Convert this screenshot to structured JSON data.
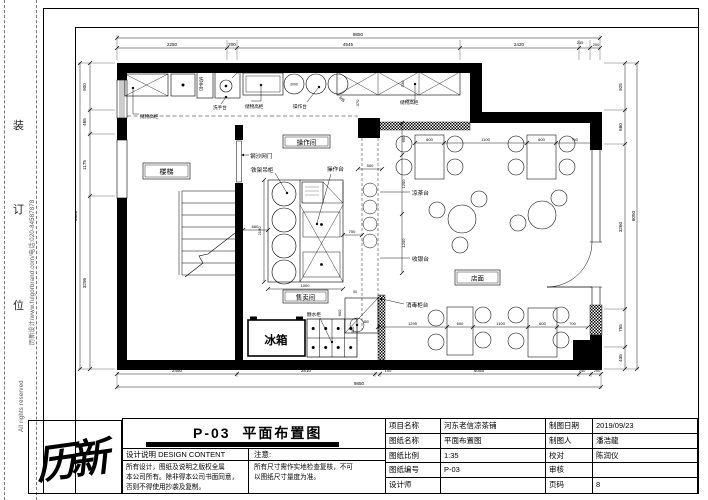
{
  "sheet": {
    "binding": [
      "装",
      "订",
      "位"
    ],
    "watermark_cn": "历新设计/www.fulgorbrand.com/电话:020-84587878",
    "watermark_en": "All rights reserved",
    "logo": "历新"
  },
  "plan": {
    "rooms": {
      "stairs": "楼梯",
      "operation": "操作间",
      "sales": "售卖间",
      "shopfront": "店面",
      "fridge": "冰箱"
    },
    "labels": {
      "storage_cabinet_1": "储物高柜",
      "storage_cabinet_2": "储物高柜",
      "storage_cabinet_3": "储物高柜",
      "wash_basin_cell": "洗手台",
      "wash_basin": "洗手台",
      "worktop_range": "操作台",
      "worktop_island": "操作台",
      "mesh_door": "钢沙网门",
      "iron_hanging_cabinet": "铁架吊柜",
      "sugar_water_cabinet": "糖水柜",
      "herbal_tea_counter": "凉茶台",
      "cashier_counter": "收银台",
      "disinfect_counter": "消毒柜台",
      "burner": "2000"
    },
    "dims": {
      "top_total": "9850",
      "top": [
        "2250",
        "200",
        "4545",
        "2420",
        "235",
        "200"
      ],
      "bottom": [
        "2450",
        "2810",
        "100",
        "4055",
        "240",
        "200"
      ],
      "bottom_total": "9850",
      "left": [
        "900",
        "465",
        "1175",
        "3295"
      ],
      "left_total": "5850",
      "right": [
        "925",
        "680",
        "3260",
        "755",
        "435"
      ],
      "right_total": "6050",
      "tables_top": [
        "600",
        "1100",
        "600",
        "750"
      ],
      "tables_bottom": [
        "1295",
        "600",
        "1100",
        "600",
        "700"
      ],
      "island_height": "2190",
      "island_width": "1000",
      "island_offset": "660",
      "island_gap": "750",
      "counter_width": "500",
      "counter_segs": [
        "650",
        "1200",
        "1200"
      ],
      "cab_370": "370",
      "cab_330": "330",
      "cab_365": "365",
      "sw_50": "50",
      "sw_600": "600",
      "sw_410": "410",
      "sw_480": "480"
    }
  },
  "titleblock": {
    "drawing_no": "P-03",
    "drawing_title": "平面布置图",
    "design_content_label": "设计说明 DESIGN CONTENT",
    "notice_label": "注意:",
    "design_content_lines": [
      "所有设计，图纸及说明之版权全属",
      "本公司所有。除非得本公司书面同意，",
      "否则不得使用抄袭及复制。"
    ],
    "notice_lines": [
      "所有尺寸需作实地检查复核，不可",
      "以图纸尺寸量度为准。"
    ],
    "info_rows": [
      [
        "项目名称",
        "河东老信凉茶铺",
        "制图日期",
        "2019/09/23"
      ],
      [
        "图纸名称",
        "平面布置图",
        "制图人",
        "潘浩龍"
      ],
      [
        "图纸比例",
        "1:35",
        "校对",
        "陈润仪"
      ],
      [
        "图纸编号",
        "P-03",
        "审核",
        ""
      ],
      [
        "设计师",
        "",
        "页码",
        "8"
      ]
    ]
  }
}
